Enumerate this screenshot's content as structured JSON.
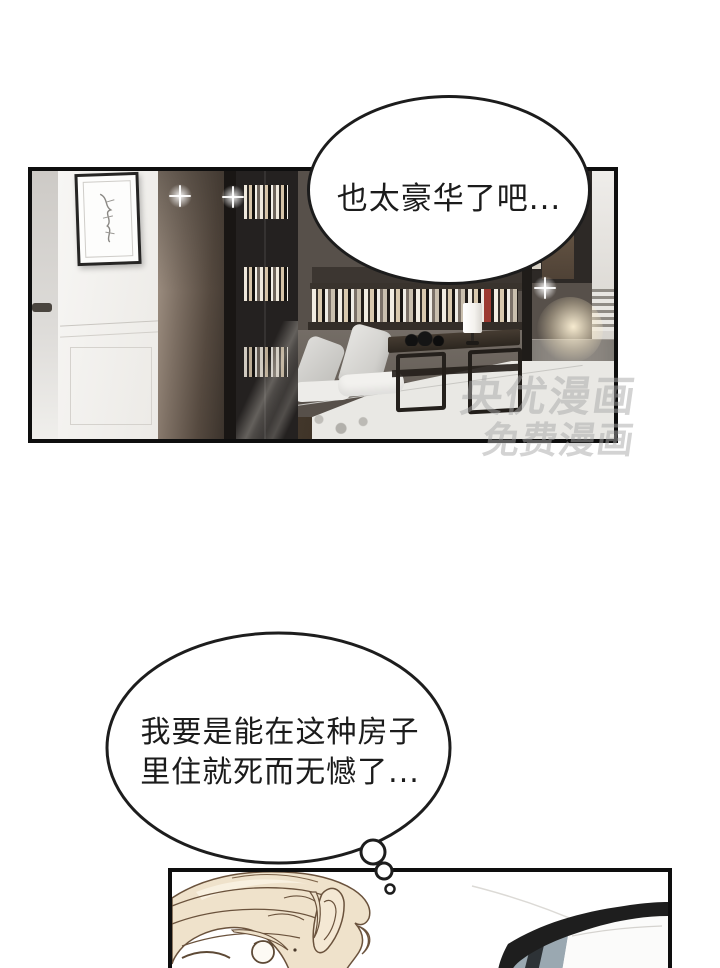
{
  "speech_bubble": {
    "text": "也太豪华了吧..."
  },
  "thought_bubble": {
    "line1": "我要是能在这种房子",
    "line2": "里住就死而无憾了..."
  },
  "watermark": {
    "line1": "央优漫画",
    "line2": "免费漫画"
  },
  "colors": {
    "panel_border": "#0e0e0e",
    "bubble_border": "#1c1c1c",
    "hair_fill": "#efe2cb",
    "hair_line": "#6a523c",
    "car_glass": "#9aa8b1",
    "watermark_gray": "#a8a8a8",
    "rug": "#e9e8e4",
    "wood_column": "#55493f"
  }
}
